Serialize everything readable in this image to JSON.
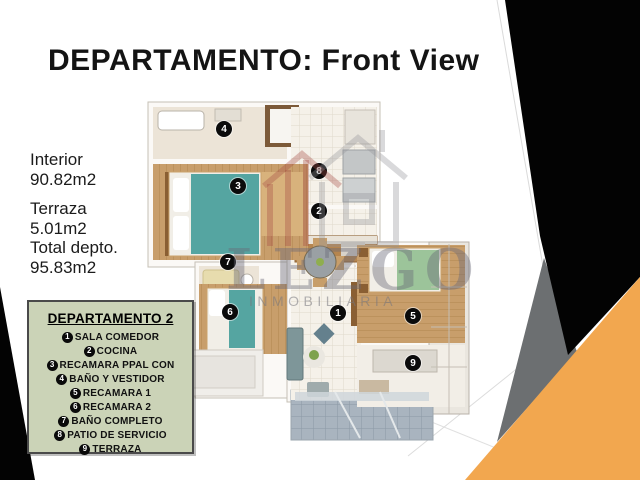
{
  "header": {
    "title": "DEPARTAMENTO: Front View"
  },
  "stats": [
    {
      "label": "Interior",
      "value": "90.82m2"
    },
    {
      "label": "Terraza",
      "value": "5.01m2"
    },
    {
      "label": "Total depto.",
      "value": "95.83m2"
    }
  ],
  "legend": {
    "title": "DEPARTAMENTO 2",
    "items": [
      {
        "num": "1",
        "label": "SALA COMEDOR"
      },
      {
        "num": "2",
        "label": "COCINA"
      },
      {
        "num": "3",
        "label": "RECAMARA PPAL CON"
      },
      {
        "num": "4",
        "label": "BAÑO Y VESTIDOR"
      },
      {
        "num": "5",
        "label": "RECAMARA 1"
      },
      {
        "num": "6",
        "label": "RECAMARA 2"
      },
      {
        "num": "7",
        "label": "BAÑO COMPLETO"
      },
      {
        "num": "8",
        "label": "PATIO DE SERVICIO"
      },
      {
        "num": "9",
        "label": "TERRAZA"
      }
    ]
  },
  "plan": {
    "markers": [
      {
        "num": "1"
      },
      {
        "num": "2"
      },
      {
        "num": "3"
      },
      {
        "num": "4"
      },
      {
        "num": "5"
      },
      {
        "num": "6"
      },
      {
        "num": "7"
      },
      {
        "num": "8"
      },
      {
        "num": "9"
      }
    ]
  },
  "watermark": {
    "brand": "LEZGO",
    "subtitle": "INMOBILIARIA",
    "icon": "house-icon"
  },
  "colors": {
    "accent_orange": "#F2A74F",
    "triangle_gray": "#6C6F71",
    "triangle_black": "#030303",
    "legend_bg": "#CBD3B7",
    "wood_floor": "#C89E6B",
    "teal_bed": "#55A5A1",
    "green_bed": "#9CC49A",
    "porch_tile": "#A9B4BF"
  }
}
